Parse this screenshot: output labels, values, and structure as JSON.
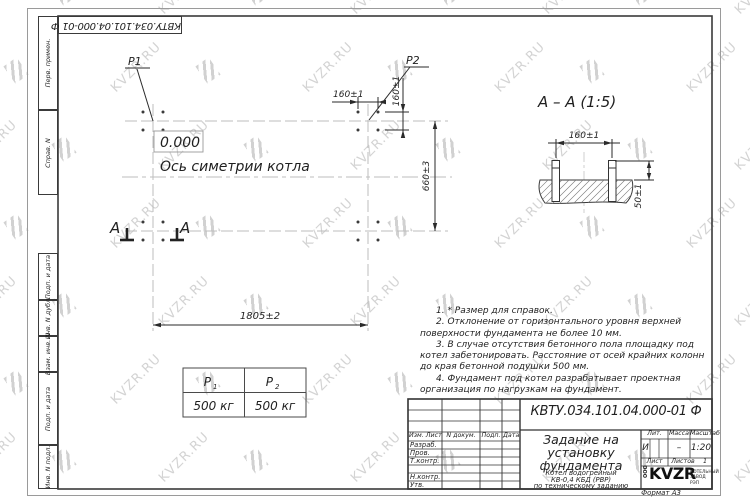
{
  "sheet": {
    "doc_number": "КВТУ.034.101.04.000-01 Ф",
    "format_note": "Формат А3"
  },
  "watermark": {
    "text": "KVZR.RU"
  },
  "frame": {
    "side_labels": [
      "Перв. примен.",
      "Справ. N",
      "Подп. и дата",
      "Инв. N дубл.",
      "Взам. инв. N",
      "Подп. и дата",
      "Инв. N подл."
    ]
  },
  "plan": {
    "elevation": "0.000",
    "symmetry_axis_label": "Ось симетрии котла",
    "p1_label": "P1",
    "p2_label": "P2",
    "section_letter": "А",
    "dim_bolt_spacing_x": "160±1",
    "dim_bolt_spacing_y": "160±1",
    "dim_row_spacing": "660±3",
    "dim_length": "1805±2"
  },
  "section_view": {
    "title": "А – А  (1:5)",
    "dim_bolt_spacing": "160±1",
    "dim_protrusion": "50±1"
  },
  "loads_table": {
    "cols": [
      {
        "head": "P",
        "sub": "1",
        "value": "500 кг"
      },
      {
        "head": "P",
        "sub": "2",
        "value": "500 кг"
      }
    ]
  },
  "notes": [
    "1.  * Размер для справок.",
    "2.  Отклонение от горизонтального уровня верхней поверхности фундамента не более 10 мм.",
    "3.  В случае отсутствия бетонного пола площадку под котел забетонировать. Расстояние от осей крайних колонн до края бетонной подушки 500 мм.",
    "4.  Фундамент под котел разрабатывает проектная организация по нагрузкам на фундамент."
  ],
  "title_block": {
    "doc_number": "КВТУ.034.101.04.000-01 Ф",
    "title_lines": [
      "Задание на",
      "установку",
      "фундамента"
    ],
    "subtitle_lines": [
      "Котел водогрейный",
      "КВ-0,4 КБД (РВР)",
      "по техническому заданию"
    ],
    "header_cells": [
      "Изм. Лист",
      "N докум.",
      "Подп.",
      "Дата"
    ],
    "role_rows": [
      "Разраб.",
      "Пров.",
      "Т.контр.",
      "",
      "Н.контр.",
      "Утв."
    ],
    "lit_label": "Лит.",
    "lit_value": "И",
    "mass_label": "Масса",
    "mass_value": "–",
    "scale_label": "Масштаб",
    "scale_value": "1:20",
    "sheet_label": "Лист",
    "sheets_label": "Листов",
    "sheets_value": "1",
    "company": {
      "prefix": "ООО",
      "logo": "KVZR",
      "name_line1": "КОТЕЛЬНЫЙ",
      "name_line2": "ЗАВОД РЭП"
    }
  }
}
